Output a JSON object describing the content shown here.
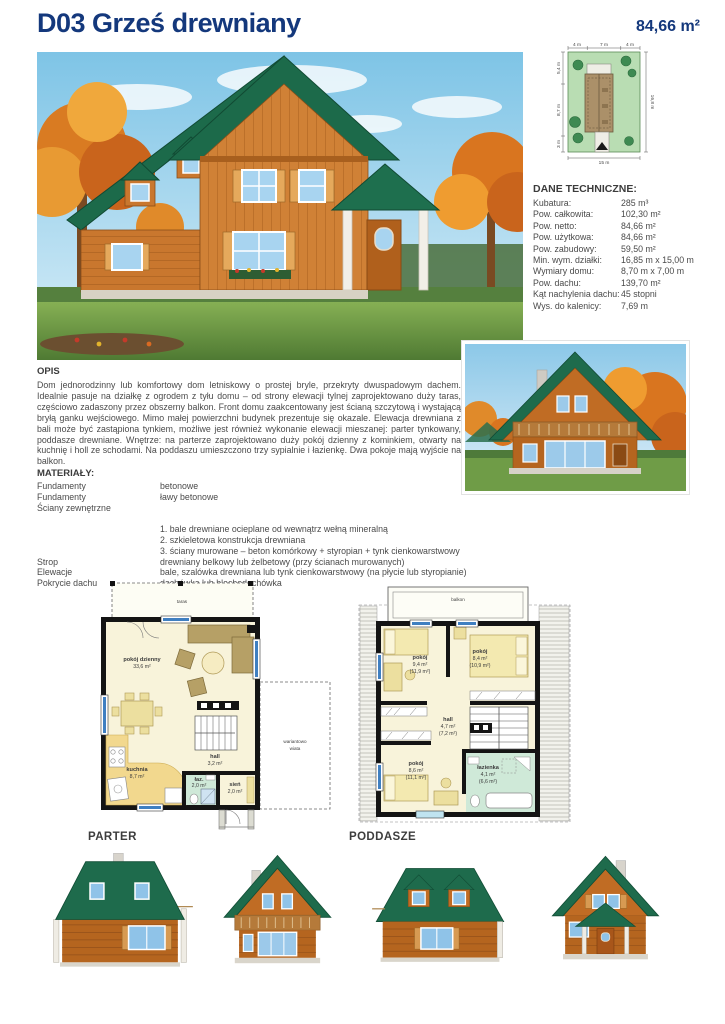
{
  "header": {
    "title": "D03 Grześ drewniany",
    "area": "84,66 m²"
  },
  "colors": {
    "title_blue": "#14387c",
    "roof_green": "#1e6b4c",
    "wood_orange": "#c9772e",
    "plan_floor": "#f8f3da",
    "plan_kitchen": "#f2d88e",
    "plan_bath": "#cfe9d8",
    "plan_window_blue": "#3f7fc1",
    "site_green": "#b9ddb3"
  },
  "site_plan": {
    "dim_top": [
      "4 m",
      "7 m",
      "4 m"
    ],
    "dim_left": [
      "5,4 m",
      "8,7 m",
      "3 m"
    ],
    "dim_right": "16,8 m",
    "dim_bottom": "15 m"
  },
  "dane": {
    "title": "DANE TECHNICZNE:",
    "rows": [
      {
        "label": "Kubatura:",
        "value": "285 m³"
      },
      {
        "label": "Pow. całkowita:",
        "value": "102,30 m²"
      },
      {
        "label": "Pow. netto:",
        "value": "84,66 m²"
      },
      {
        "label": "Pow. użytkowa:",
        "value": "84,66 m²"
      },
      {
        "label": "Pow. zabudowy:",
        "value": "59,50 m²"
      },
      {
        "label": "Min. wym. działki:",
        "value": "16,85 m x 15,00 m"
      },
      {
        "label": "Wymiary domu:",
        "value": "8,70 m x 7,00 m"
      },
      {
        "label": "Pow. dachu:",
        "value": "139,70 m²"
      },
      {
        "label": "Kąt nachylenia dachu:",
        "value": "45 stopni"
      },
      {
        "label": "Wys. do kalenicy:",
        "value": "7,69 m"
      }
    ]
  },
  "opis": {
    "title": "OPIS",
    "text": "Dom jednorodzinny lub komfortowy dom letniskowy o prostej bryle, przekryty dwuspadowym dachem. Idealnie pasuje na działkę z ogrodem z tyłu domu – od strony elewacji tylnej zaprojektowano duży taras, częściowo zadaszony przez obszerny balkon. Front domu zaakcentowany jest ścianą szczytową i wystającą bryłą ganku wejściowego. Mimo małej powierzchni budynek prezentuje się okazale. Elewacja drewniana z bali może być zastąpiona tynkiem, możliwe jest również wykonanie elewacji mieszanej: parter tynkowany, poddasze drewniane. Wnętrze: na parterze zaprojektowano duży pokój dzienny z kominkiem, otwarty na kuchnię i holl ze schodami. Na poddaszu umieszczono trzy sypialnie i łazienkę. Dwa pokoje mają wyjście na balkon."
  },
  "materialy": {
    "title": "MATERIAŁY:",
    "rows": [
      {
        "label": "Fundamenty",
        "value": "betonowe"
      },
      {
        "label": "Fundamenty",
        "value": "ławy betonowe"
      },
      {
        "label": "Ściany zewnętrzne",
        "value": ""
      },
      {
        "label": "",
        "value": ""
      },
      {
        "label": "",
        "value": "1. bale drewniane ocieplane od wewnątrz wełną mineralną"
      },
      {
        "label": "",
        "value": "2. szkieletowa konstrukcja drewniana"
      },
      {
        "label": "",
        "value": "3. ściany murowane – beton komórkowy + styropian + tynk cienkowarstwowy"
      },
      {
        "label": "Strop",
        "value": "drewniany belkowy lub żelbetowy (przy ścianach murowanych)"
      },
      {
        "label": "Elewacje",
        "value": "bale, szalówka drewniana lub tynk cienkowarstwowy (na płycie lub styropianie)"
      },
      {
        "label": "Pokrycie dachu",
        "value": "dachówka lub blachodachówka"
      }
    ]
  },
  "plans": {
    "parter": {
      "caption": "PARTER",
      "taras": "taras",
      "wiata_line1": "wariantowo",
      "wiata_line2": "wiata",
      "rooms": {
        "pokoj_dzienny": {
          "name": "pokój dzienny",
          "area": "33,6 m²"
        },
        "kuchnia": {
          "name": "kuchnia",
          "area": "8,7 m²"
        },
        "hall": {
          "name": "hall",
          "area": "3,2 m²"
        },
        "laz": {
          "name": "łaz.",
          "area": "2,0 m²"
        },
        "sien": {
          "name": "sień",
          "area": "2,0 m²"
        }
      }
    },
    "poddasze": {
      "caption": "PODDASZE",
      "balkon": "balkon",
      "rooms": {
        "pokoj1": {
          "name": "pokój",
          "area": "9,4 m²",
          "area2": "(11,9 m²)"
        },
        "pokoj2": {
          "name": "pokój",
          "area": "8,4 m²",
          "area2": "(10,9 m²)"
        },
        "hall": {
          "name": "hall",
          "area": "4,7 m²",
          "area2": "(7,2 m²)"
        },
        "pokoj3": {
          "name": "pokój",
          "area": "8,6 m²",
          "area2": "(11,1 m²)"
        },
        "lazienka": {
          "name": "łazienka",
          "area": "4,1 m²",
          "area2": "(6,6 m²)"
        }
      }
    }
  }
}
